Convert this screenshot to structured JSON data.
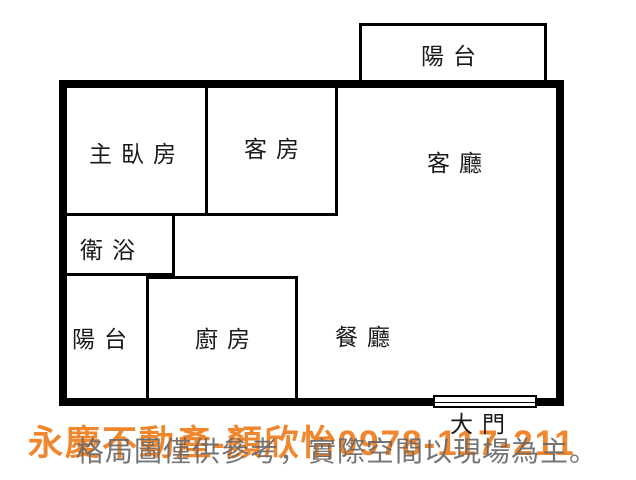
{
  "floor_plan": {
    "rooms": [
      {
        "id": "balcony-top",
        "label": "陽台"
      },
      {
        "id": "master-bedroom",
        "label": "主臥房"
      },
      {
        "id": "guest-room",
        "label": "客房"
      },
      {
        "id": "living-room",
        "label": "客廳"
      },
      {
        "id": "bathroom",
        "label": "衛浴"
      },
      {
        "id": "balcony-bottom",
        "label": "陽台"
      },
      {
        "id": "kitchen",
        "label": "廚房"
      },
      {
        "id": "dining-room",
        "label": "餐廳"
      }
    ],
    "door_label": "大門"
  },
  "watermark": {
    "agent_line": "永慶不動產-顏欣怡0978-117-211",
    "brand": "永慶不動產",
    "agent_name": "顏欣怡",
    "phone": "0978-117-211",
    "disclaimer": "格局圖僅供參考，實際空間以現場為主。"
  },
  "colors": {
    "wall": "#000000",
    "label_text": "#1a1a1a",
    "agent_text": "#F0862D",
    "disclaimer_text": "#696969",
    "background": "#ffffff"
  }
}
